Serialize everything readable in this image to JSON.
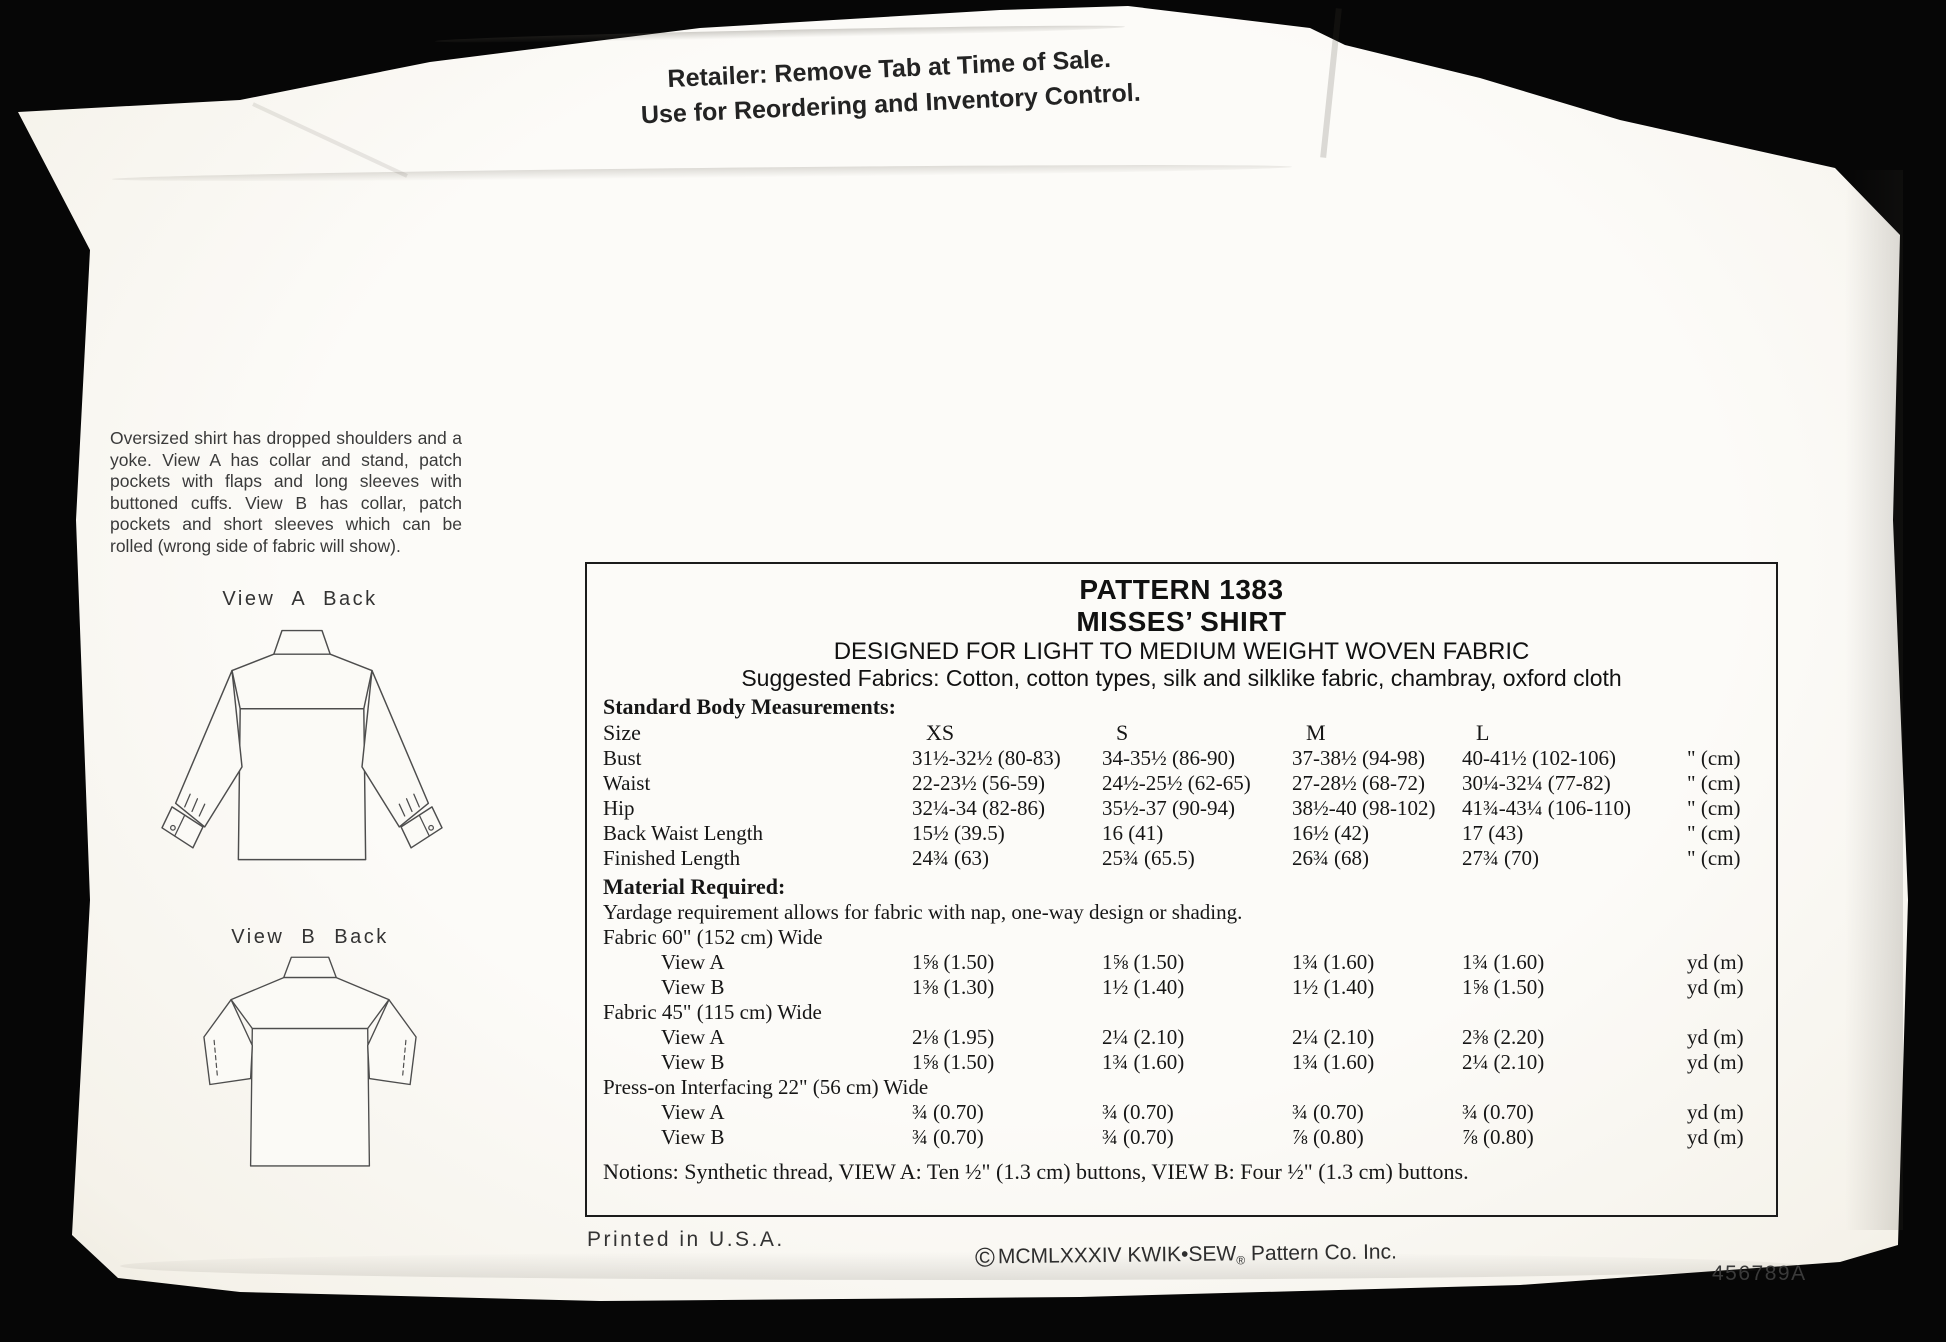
{
  "retailer_notice": {
    "line1": "Retailer: Remove Tab at Time of Sale.",
    "line2": "Use for Reordering and Inventory Control."
  },
  "description": "Oversized shirt has dropped shoulders and a yoke. View A has collar and stand, patch pockets with flaps and long sleeves with buttoned cuffs. View B has collar, patch pockets and short sleeves which can be rolled (wrong side of fabric will show).",
  "views": {
    "view_a_label": "View A Back",
    "view_b_label": "View B Back"
  },
  "pattern_info": {
    "title": "PATTERN 1383",
    "subtitle": "MISSES’ SHIRT",
    "designed_for": "DESIGNED FOR LIGHT TO MEDIUM WEIGHT WOVEN FABRIC",
    "suggested_fabrics": "Suggested Fabrics: Cotton, cotton types, silk and silklike fabric, chambray, oxford cloth"
  },
  "measurements": {
    "heading": "Standard Body Measurements:",
    "size_row": {
      "label": "Size",
      "xs": "XS",
      "s": "S",
      "m": "M",
      "l": "L",
      "unit": ""
    },
    "rows": [
      {
        "label": "Bust",
        "xs": "31½-32½ (80-83)",
        "s": "34-35½ (86-90)",
        "m": "37-38½ (94-98)",
        "l": "40-41½ (102-106)",
        "unit": "\" (cm)"
      },
      {
        "label": "Waist",
        "xs": "22-23½ (56-59)",
        "s": "24½-25½ (62-65)",
        "m": "27-28½ (68-72)",
        "l": "30¼-32¼ (77-82)",
        "unit": "\" (cm)"
      },
      {
        "label": "Hip",
        "xs": "32¼-34 (82-86)",
        "s": "35½-37 (90-94)",
        "m": "38½-40 (98-102)",
        "l": "41¾-43¼ (106-110)",
        "unit": "\" (cm)"
      },
      {
        "label": "Back Waist Length",
        "xs": "15½ (39.5)",
        "s": "16 (41)",
        "m": "16½ (42)",
        "l": "17 (43)",
        "unit": "\" (cm)"
      },
      {
        "label": "Finished Length",
        "xs": "24¾ (63)",
        "s": "25¾ (65.5)",
        "m": "26¾ (68)",
        "l": "27¾ (70)",
        "unit": "\" (cm)"
      }
    ]
  },
  "material": {
    "heading": "Material Required:",
    "note": "Yardage requirement allows for fabric with nap, one-way design or shading.",
    "sections": [
      {
        "heading": "Fabric 60\" (152 cm) Wide",
        "rows": [
          {
            "label": "View A",
            "xs": "1⅝ (1.50)",
            "s": "1⅝ (1.50)",
            "m": "1¾ (1.60)",
            "l": "1¾ (1.60)",
            "unit": "yd (m)"
          },
          {
            "label": "View B",
            "xs": "1⅜ (1.30)",
            "s": "1½ (1.40)",
            "m": "1½ (1.40)",
            "l": "1⅝ (1.50)",
            "unit": "yd (m)"
          }
        ]
      },
      {
        "heading": "Fabric 45\" (115 cm) Wide",
        "rows": [
          {
            "label": "View A",
            "xs": "2⅛ (1.95)",
            "s": "2¼ (2.10)",
            "m": "2¼ (2.10)",
            "l": "2⅜ (2.20)",
            "unit": "yd (m)"
          },
          {
            "label": "View B",
            "xs": "1⅝ (1.50)",
            "s": "1¾ (1.60)",
            "m": "1¾ (1.60)",
            "l": "2¼ (2.10)",
            "unit": "yd (m)"
          }
        ]
      },
      {
        "heading": "Press-on Interfacing 22\" (56 cm) Wide",
        "rows": [
          {
            "label": "View A",
            "xs": "¾ (0.70)",
            "s": "¾ (0.70)",
            "m": "¾ (0.70)",
            "l": "¾ (0.70)",
            "unit": "yd (m)"
          },
          {
            "label": "View B",
            "xs": "¾ (0.70)",
            "s": "¾ (0.70)",
            "m": "⅞ (0.80)",
            "l": "⅞ (0.80)",
            "unit": "yd (m)"
          }
        ]
      }
    ],
    "notions": "Notions: Synthetic thread, VIEW A: Ten ½\" (1.3 cm) buttons, VIEW B: Four ½\" (1.3 cm) buttons."
  },
  "footer": {
    "printed": "Printed in U.S.A.",
    "copyright_symbol": "©",
    "copyright_text": "MCMLXXXIV KWIK•SEW",
    "registered_mark": "®",
    "copyright_tail": " Pattern Co. Inc.",
    "stock_number": "456789A"
  }
}
